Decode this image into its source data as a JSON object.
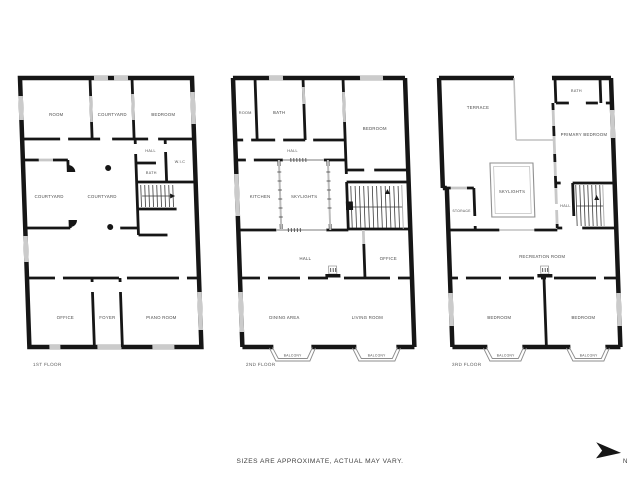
{
  "canvas": {
    "background": "#ffffff",
    "wall_color": "#161616",
    "window_color": "#cbcbcb",
    "label_color": "#4b4b4b"
  },
  "floors": [
    {
      "label": "1ST FLOOR",
      "rooms": {
        "room": "ROOM",
        "courtyard_top": "COURTYARD",
        "bedroom": "BEDROOM",
        "hall": "HALL",
        "wic": "W.I.C",
        "bath": "BATH",
        "courtyard_left": "COURTYARD",
        "courtyard_center": "COURTYARD",
        "office": "OFFICE",
        "foyer": "FOYER",
        "piano_room": "PIANO ROOM"
      }
    },
    {
      "label": "2ND FLOOR",
      "rooms": {
        "room": "ROOM",
        "bath": "BATH",
        "bedroom": "BEDROOM",
        "hall_upper": "HALL",
        "kitchen": "KITCHEN",
        "skylights": "SKYLIGHTS",
        "hall_lower": "HALL",
        "office": "OFFICE",
        "dining_area": "DINING AREA",
        "living_room": "LIVING ROOM",
        "balcony_left": "BALCONY",
        "balcony_right": "BALCONY"
      }
    },
    {
      "label": "3RD FLOOR",
      "rooms": {
        "terrace": "TERRACE",
        "bath": "BATH",
        "primary_bedroom": "PRIMARY BEDROOM",
        "skylights": "SKYLIGHTS",
        "storage": "STORAGE",
        "hall": "HALL",
        "recreation_room": "RECREATION ROOM",
        "bedroom_left": "BEDROOM",
        "bedroom_right": "BEDROOM",
        "balcony_left": "BALCONY",
        "balcony_right": "BALCONY"
      }
    }
  ],
  "footer": {
    "disclaimer": "SIZES ARE APPROXIMATE, ACTUAL MAY VARY.",
    "compass": "N"
  }
}
